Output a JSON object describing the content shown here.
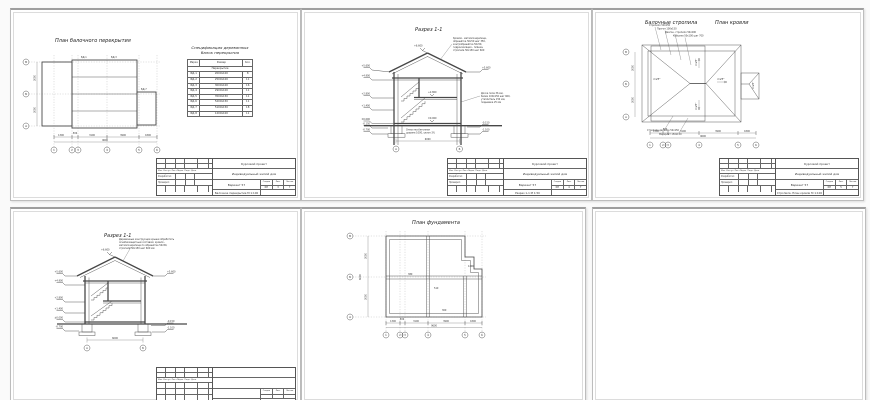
{
  "stamp": {
    "project": "Курсовой проект",
    "object": "Индивидуальный жилой дом",
    "variant": "Вариант 57",
    "stage_h": "Стадия",
    "sheet_h": "Лист",
    "sheets_h": "Листов",
    "stage": "КП",
    "cols_header": "Изм. Кол.уч. Лист №док. Подп. Дата",
    "developed": "Разработал",
    "checked": "Проверил"
  },
  "axes": {
    "b1": "1",
    "b2": "2",
    "b3": "3",
    "b4": "4",
    "b5": "5",
    "b6": "6",
    "lA": "А",
    "lB": "Б",
    "lV": "В",
    "d1": "1300",
    "d2": "500",
    "d3": "3100",
    "d4": "3900",
    "d5": "1800",
    "total_b": "9600",
    "dl1": "3000",
    "dl2": "3000",
    "total_l": "6000"
  },
  "s1": {
    "title": "План балочного перекрытия",
    "stamp_doc": "Балочное перекрытие М 1:100",
    "sheet_no": "3",
    "sheets_total": "7",
    "mark1": "БД-1",
    "mark2": "БД-3",
    "mark3": "БД-7",
    "spec": {
      "title1": "Спецификация деревянных",
      "title2": "балок перекрытия",
      "h": [
        "Марка",
        "Размер",
        "Кол."
      ],
      "section": "Перекрытие",
      "rows": [
        [
          "БД-1",
          "2000х100",
          "8"
        ],
        [
          "БД-2",
          "2500х100",
          "11"
        ],
        [
          "БД-3",
          "3000х100",
          "16"
        ],
        [
          "БД-4",
          "2900х100",
          "11"
        ],
        [
          "БД-5",
          "3500х150",
          "11"
        ],
        [
          "БД-6",
          "5200х150",
          "11"
        ],
        [
          "БД-7",
          "5100х150",
          "18"
        ],
        [
          "БД-8",
          "1200х100",
          "11"
        ]
      ]
    }
  },
  "s2": {
    "title": "Разрез 1-1",
    "stamp_doc": "Разрез 1-1  М 1:50",
    "sheet_no": "4",
    "sheets_total": "7",
    "apex": "+6.600",
    "elev_left": [
      "+5.600",
      "+4.900",
      "+2.800",
      "+1.400",
      "±0.000",
      "-0.150",
      "-0.700"
    ],
    "elev_right": [
      "+5.600",
      "-0.150",
      "-1.100"
    ],
    "elev_in1": "+2.800",
    "elev_in2": "±0.000",
    "roof_note": [
      "Кровля - металлочерепица,",
      "обрешётка 50х50 шаг 350,",
      "контробрешётка 50х50,",
      "гидроизоляция - плёнка,",
      "стропила 50х150 шаг 600"
    ],
    "floor_note": [
      "Доска пола 36 мм,",
      "балки 100х150 шаг 600,",
      "утеплитель 150 мм,",
      "подшивка 25 мм"
    ],
    "base_note": [
      "Отмостка бетонная",
      "ширина 1000, уклон 3%"
    ],
    "width_dim": "6000",
    "ax_l": "А",
    "ax_r": "Б"
  },
  "s3": {
    "title_left": "Балочные стропила",
    "title_right": "План кровли",
    "stamp_doc": "Стропила. План кровли М 1:100",
    "sheet_no": "5",
    "sheets_total": "7",
    "slope": "i=25°",
    "notes_top": [
      "Стропило 50х150",
      "Прогон 100х150",
      "Диагон. стропило 50х200",
      "Кобылка 50х100 шаг 700"
    ],
    "notes_bottom": [
      "Стропило двойное 50х150",
      "Мауэрлат 150х150"
    ]
  },
  "s4": {
    "title": "Разрез 1-1",
    "apex": "+6.600",
    "elev_left": [
      "+5.600",
      "+4.900",
      "+2.800",
      "+1.400",
      "±0.000",
      "-0.700"
    ],
    "elev_right": [
      "+5.600",
      "-0.150",
      "-1.100"
    ],
    "roof_note": [
      "Деревянные конструкции крыши обработать",
      "огнебиозащитным составом; кровля -",
      "металлочерепица по обрешётке 50х50,",
      "стропила 50х150 шаг 600 мм"
    ],
    "width_dim": "6000",
    "ax_l": "А",
    "ax_r": "Б"
  },
  "s5": {
    "title": "План фундамента",
    "dim_in1": "380",
    "dim_in2": "510",
    "dim_in3": "300",
    "dim_in4": "1200"
  }
}
